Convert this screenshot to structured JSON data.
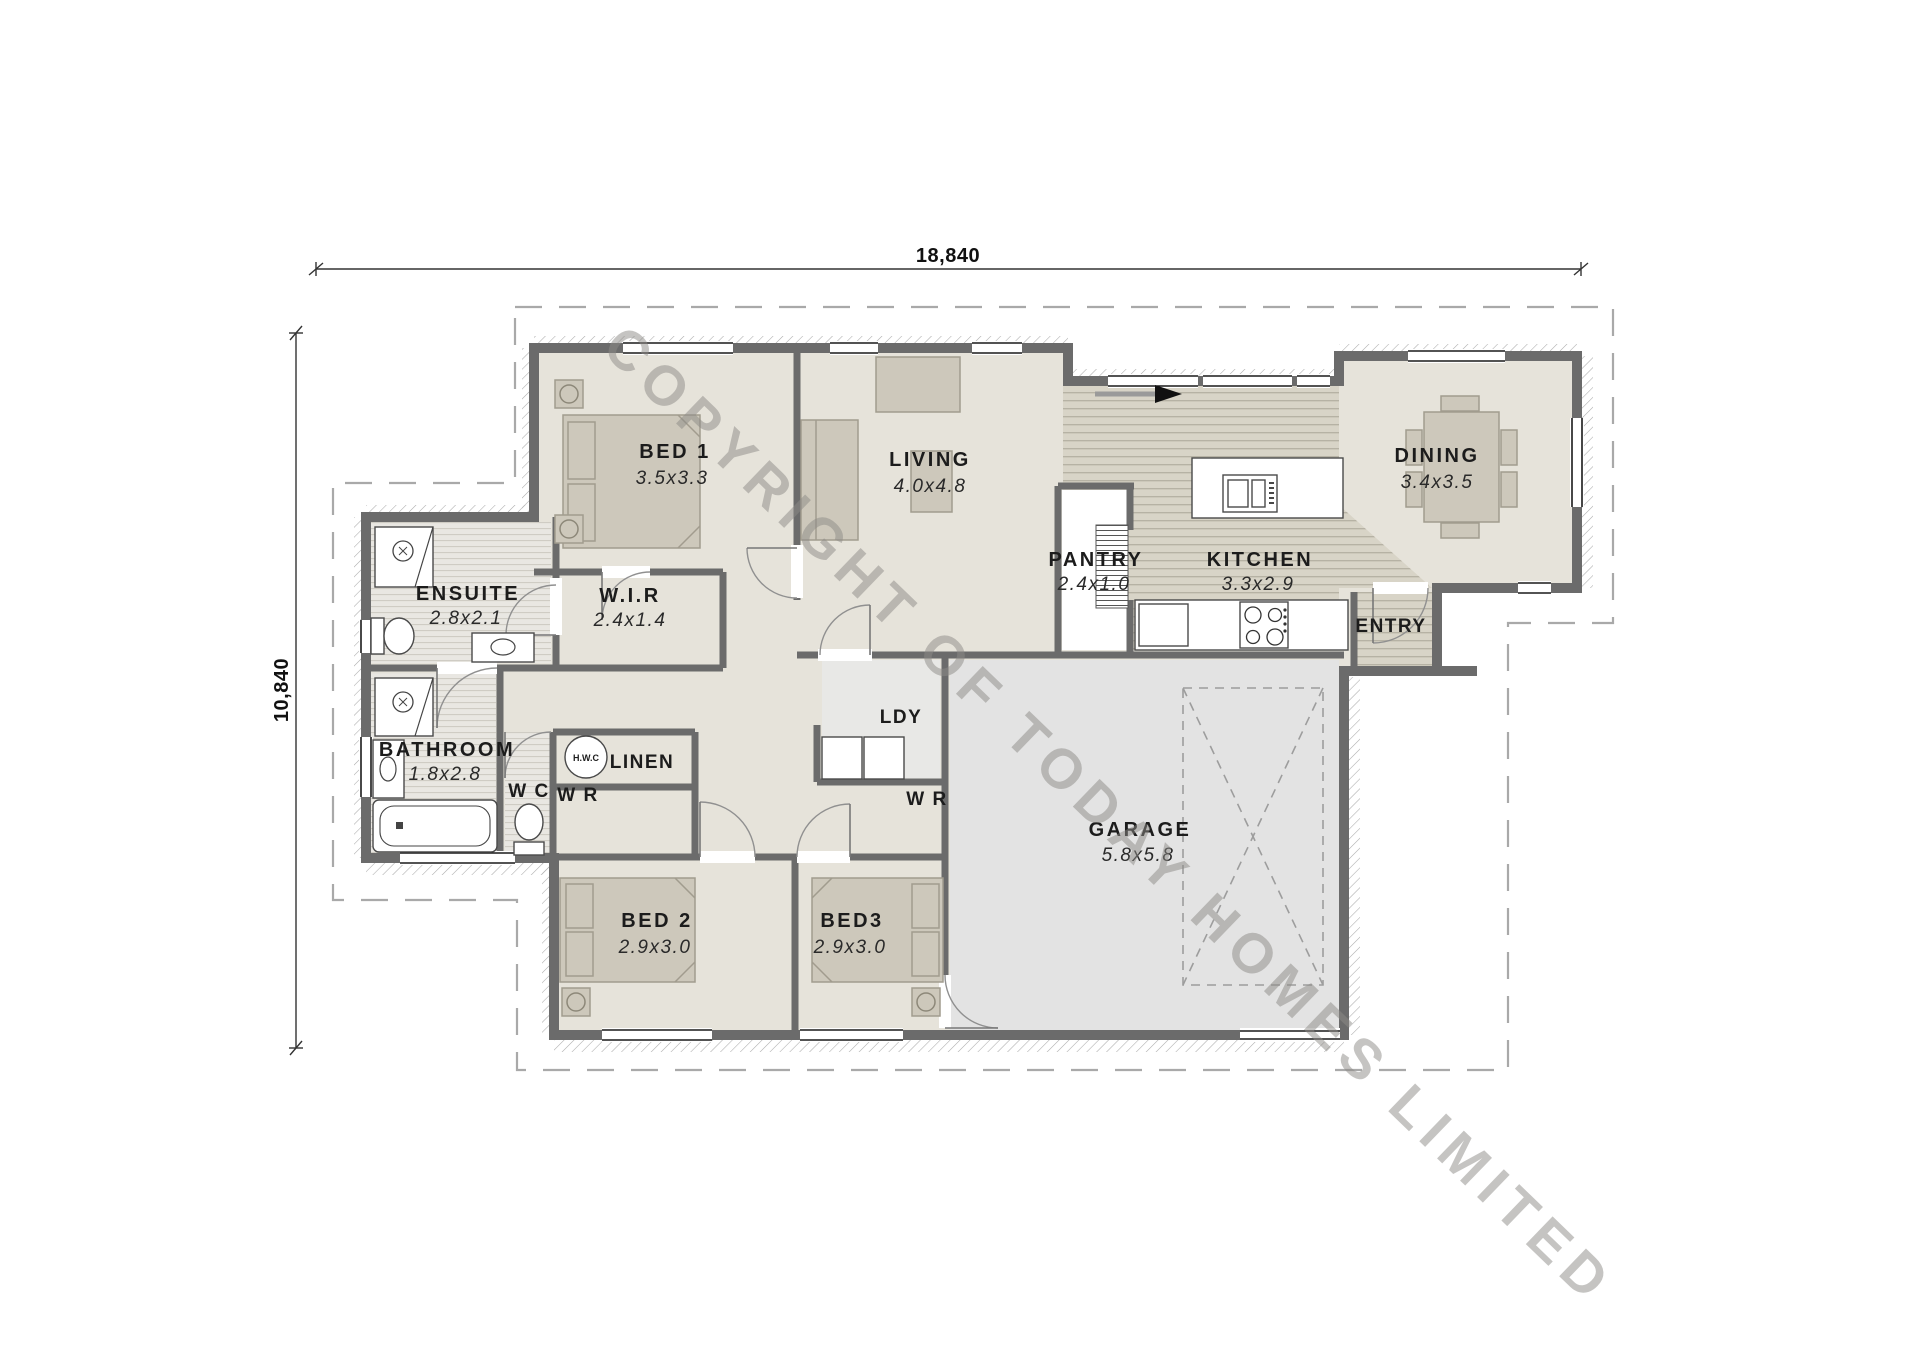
{
  "watermark": "COPYRIGHT OF TODAY HOMES LIMITED",
  "overall_dimensions": {
    "width_label": "18,840",
    "height_label": "10,840"
  },
  "rooms": [
    {
      "name": "BED 1",
      "dims": "3.5x3.3"
    },
    {
      "name": "LIVING",
      "dims": "4.0x4.8"
    },
    {
      "name": "DINING",
      "dims": "3.4x3.5"
    },
    {
      "name": "ENSUITE",
      "dims": "2.8x2.1"
    },
    {
      "name": "W.I.R",
      "dims": "2.4x1.4"
    },
    {
      "name": "PANTRY",
      "dims": "2.4x1.0"
    },
    {
      "name": "KITCHEN",
      "dims": "3.3x2.9"
    },
    {
      "name": "ENTRY",
      "dims": ""
    },
    {
      "name": "BATHROOM",
      "dims": "1.8x2.8"
    },
    {
      "name": "W C",
      "dims": ""
    },
    {
      "name": "LINEN",
      "dims": ""
    },
    {
      "name": "H.W.C",
      "dims": ""
    },
    {
      "name": "W R",
      "dims": ""
    },
    {
      "name": "LDY",
      "dims": ""
    },
    {
      "name": "W R",
      "dims": ""
    },
    {
      "name": "BED 2",
      "dims": "2.9x3.0"
    },
    {
      "name": "BED3",
      "dims": "2.9x3.0"
    },
    {
      "name": "GARAGE",
      "dims": "5.8x5.8"
    }
  ],
  "colors": {
    "wall": "#6b6b6b",
    "carpet_floor": "#e6e3da",
    "timber_floor": "#d8d4c7",
    "garage_floor": "#e3e3e3",
    "tile_floor": "#e9e7e2",
    "watermark_gray": "#8d8b87"
  }
}
